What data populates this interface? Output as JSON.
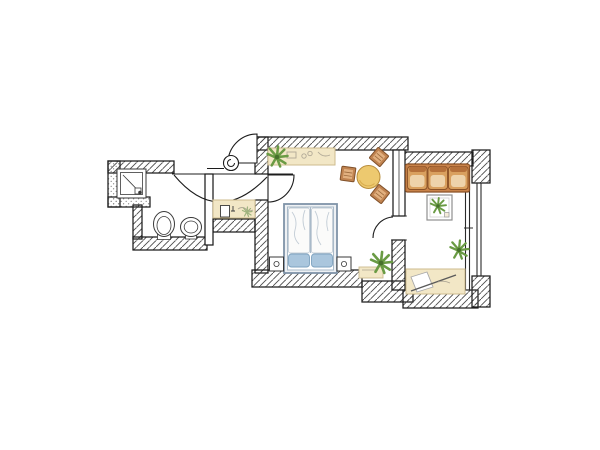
{
  "title": "Hand-drawn apartment floor plan",
  "type": "floor-plan",
  "palette": {
    "background": "#ffffff",
    "wall_outline": "#1c1c1c",
    "wall_hatch": "#4a4a4a",
    "wall_stipple": "#8a8a8a",
    "wall_fill": "#ffffff",
    "counter_beige": "#f2e7c6",
    "counter_edge": "#cdbb8e",
    "counter_sketch": "#b0a896",
    "table_top": "#edc96f",
    "table_edge": "#b98e3c",
    "table_shade": "#d9ad4e",
    "stool_fill": "#c08350",
    "stool_inner": "#e2b07f",
    "stool_edge": "#80512a",
    "stool_line": "#9c6b3d",
    "sofa_base": "#c9834a",
    "sofa_cushion": "#d9a05f",
    "sofa_cushion_inner": "#eed3ab",
    "sofa_back_strip": "#b5703a",
    "sofa_edge": "#8a5126",
    "bed_frame": "#7f93a8",
    "bed_fill": "#eef1f4",
    "bed_inner": "#a9bac9",
    "duvet": "#fbfbfa",
    "duvet_crease": "#c3cdd6",
    "pillow": "#aac6dd",
    "pillow_edge": "#7fa3c0",
    "plant_leaf": "#6a9b44",
    "plant_core": "#47702c",
    "plant_faint": "#9fb37e",
    "fixture_stroke": "#3a3a3a",
    "desk_line": "#5a5a5a",
    "window_line": "#2a2a2a"
  },
  "rooms": [
    {
      "id": "bathroom",
      "label": "Bathroom",
      "fixtures": [
        "shower-tray",
        "toilet",
        "bidet"
      ]
    },
    {
      "id": "entry-hall",
      "label": "Entry hall",
      "fixtures": [
        "entrance-door",
        "vanity-sink",
        "double-swing-doors",
        "door-knob-symbol"
      ]
    },
    {
      "id": "main-room",
      "label": "Living / bedroom",
      "furniture": [
        "kitchenette-counter",
        "potted-plant",
        "round-dining-table",
        "wicker-stool",
        "wicker-stool",
        "wicker-stool",
        "double-bed",
        "nightstand",
        "nightstand",
        "potted-plant",
        "low-shelf"
      ]
    },
    {
      "id": "second-room",
      "label": "Sitting room",
      "furniture": [
        "three-seat-sofa",
        "side-table-with-plant",
        "potted-plant",
        "writing-desk"
      ],
      "features": [
        "full-height-window"
      ]
    }
  ],
  "doors": [
    {
      "id": "entrance-door",
      "between": [
        "outside",
        "entry-hall"
      ],
      "swing": "quarter-arc"
    },
    {
      "id": "bathroom-door",
      "between": [
        "entry-hall",
        "bathroom"
      ],
      "swing": "scallop-arc"
    },
    {
      "id": "main-room-door",
      "between": [
        "entry-hall",
        "main-room"
      ],
      "swing": "quarter-arc"
    },
    {
      "id": "connecting-door",
      "between": [
        "main-room",
        "second-room"
      ],
      "swing": "quarter-arc"
    }
  ],
  "windows": [
    {
      "id": "window-east",
      "room": "second-room",
      "wall": "east"
    }
  ]
}
